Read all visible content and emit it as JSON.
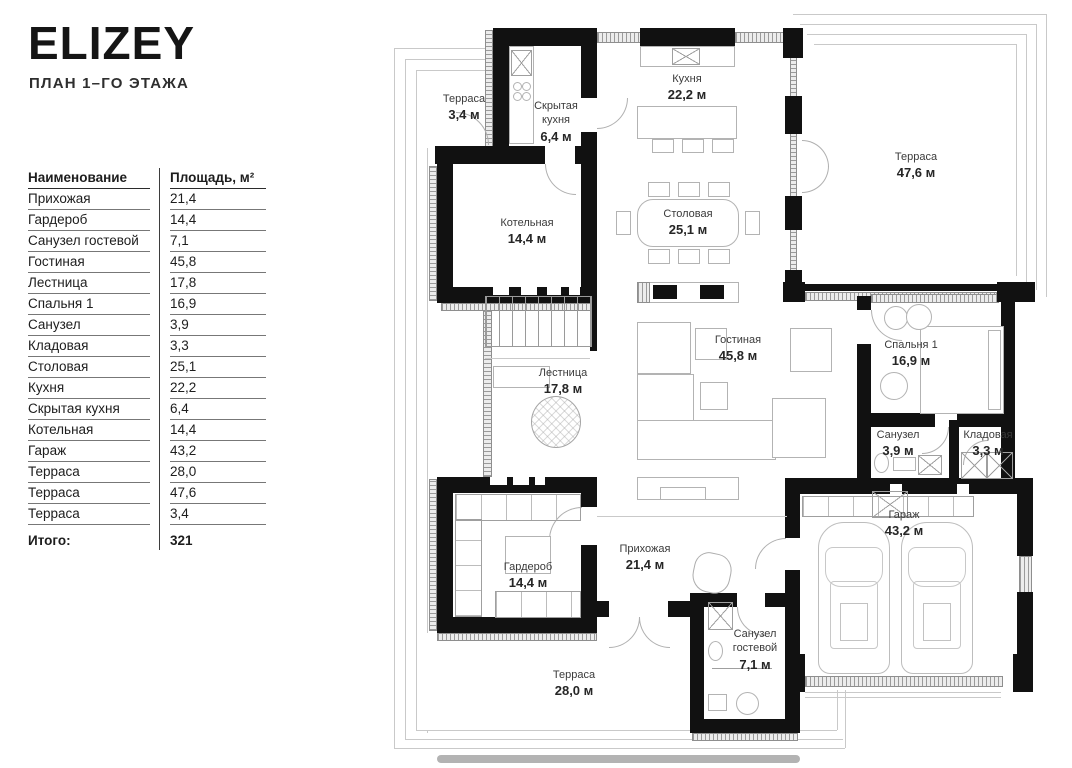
{
  "header": {
    "title": "ELIZEY",
    "subtitle": "ПЛАН 1–ГО ЭТАЖА"
  },
  "table": {
    "columns": {
      "name": "Наименование",
      "area": "Площадь, м²"
    },
    "rows": [
      {
        "name": "Прихожая",
        "area": "21,4"
      },
      {
        "name": "Гардероб",
        "area": "14,4"
      },
      {
        "name": "Санузел гостевой",
        "area": "7,1"
      },
      {
        "name": "Гостиная",
        "area": "45,8"
      },
      {
        "name": "Лестница",
        "area": "17,8"
      },
      {
        "name": "Спальня 1",
        "area": "16,9"
      },
      {
        "name": "Санузел",
        "area": "3,9"
      },
      {
        "name": "Кладовая",
        "area": "3,3"
      },
      {
        "name": "Столовая",
        "area": "25,1"
      },
      {
        "name": "Кухня",
        "area": "22,2"
      },
      {
        "name": "Скрытая кухня",
        "area": "6,4"
      },
      {
        "name": "Котельная",
        "area": "14,4"
      },
      {
        "name": "Гараж",
        "area": "43,2"
      },
      {
        "name": "Терраса",
        "area": "28,0"
      },
      {
        "name": "Терраса",
        "area": "47,6"
      },
      {
        "name": "Терраса",
        "area": "3,4"
      }
    ],
    "total": {
      "label": "Итого:",
      "value": "321"
    }
  },
  "plan": {
    "rooms": [
      {
        "name": "Терраса",
        "area": "3,4 м"
      },
      {
        "name": "Скрытая кухня",
        "area": "6,4 м"
      },
      {
        "name": "Кухня",
        "area": "22,2 м"
      },
      {
        "name": "Терраса",
        "area": "47,6 м"
      },
      {
        "name": "Котельная",
        "area": "14,4 м"
      },
      {
        "name": "Столовая",
        "area": "25,1 м"
      },
      {
        "name": "Гостиная",
        "area": "45,8 м"
      },
      {
        "name": "Лестница",
        "area": "17,8 м"
      },
      {
        "name": "Спальня 1",
        "area": "16,9 м"
      },
      {
        "name": "Санузел",
        "area": "3,9 м"
      },
      {
        "name": "Кладовая",
        "area": "3,3 м"
      },
      {
        "name": "Гараж",
        "area": "43,2 м"
      },
      {
        "name": "Гардероб",
        "area": "14,4 м"
      },
      {
        "name": "Прихожая",
        "area": "21,4 м"
      },
      {
        "name": "Санузел гостевой",
        "area": "7,1 м"
      },
      {
        "name": "Терраса",
        "area": "28,0 м"
      }
    ],
    "colors": {
      "wall": "#111111",
      "furniture_line": "#b3b3b3",
      "outline": "#c9c9c9"
    }
  }
}
